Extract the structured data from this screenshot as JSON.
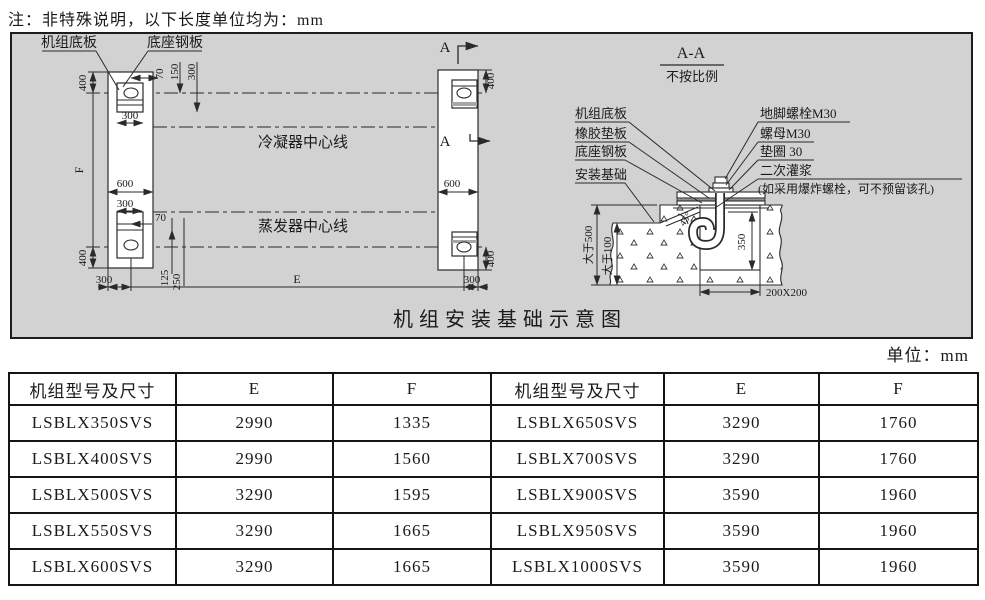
{
  "note": "注：非特殊说明，以下长度单位均为：mm",
  "unit_note": "单位：mm",
  "caption": "机组安装基础示意图",
  "plan": {
    "unit_base_plate": "机组底板",
    "base_steel_plate": "底座钢板",
    "condenser_centerline": "冷凝器中心线",
    "evaporator_centerline": "蒸发器中心线",
    "section_marker": "A",
    "dim_400": "400",
    "dim_70": "70",
    "dim_150": "150",
    "dim_300": "300",
    "dim_600": "600",
    "dim_125": "125",
    "dim_250": "250",
    "dim_F": "F",
    "dim_E": "E"
  },
  "section": {
    "title": "A-A",
    "scale_note": "不按比例",
    "unit_base_plate": "机组底板",
    "rubber_pad": "橡胶垫板",
    "base_steel_plate": "底座钢板",
    "foundation": "安装基础",
    "anchor_bolt": "地脚螺栓M30",
    "nut": "螺母M30",
    "washer": "垫圈 30",
    "grout": "二次灌浆",
    "grout_note": "(如采用爆炸螺栓，可不预留该孔)",
    "dim_gt500": "大于500",
    "dim_gt100": "大于100",
    "dim_350": "350",
    "dim_pocket": "200X200",
    "dim_angle": "45°"
  },
  "table": {
    "headers": [
      "机组型号及尺寸",
      "E",
      "F",
      "机组型号及尺寸",
      "E",
      "F"
    ],
    "rows": [
      [
        "LSBLX350SVS",
        "2990",
        "1335",
        "LSBLX650SVS",
        "3290",
        "1760"
      ],
      [
        "LSBLX400SVS",
        "2990",
        "1560",
        "LSBLX700SVS",
        "3290",
        "1760"
      ],
      [
        "LSBLX500SVS",
        "3290",
        "1595",
        "LSBLX900SVS",
        "3590",
        "1960"
      ],
      [
        "LSBLX550SVS",
        "3290",
        "1665",
        "LSBLX950SVS",
        "3590",
        "1960"
      ],
      [
        "LSBLX600SVS",
        "3290",
        "1665",
        "LSBLX1000SVS",
        "3590",
        "1960"
      ]
    ]
  },
  "colors": {
    "diagram_bg": "#d2d2d2",
    "line": "#2a2a2a",
    "text": "#1a1a1a"
  }
}
